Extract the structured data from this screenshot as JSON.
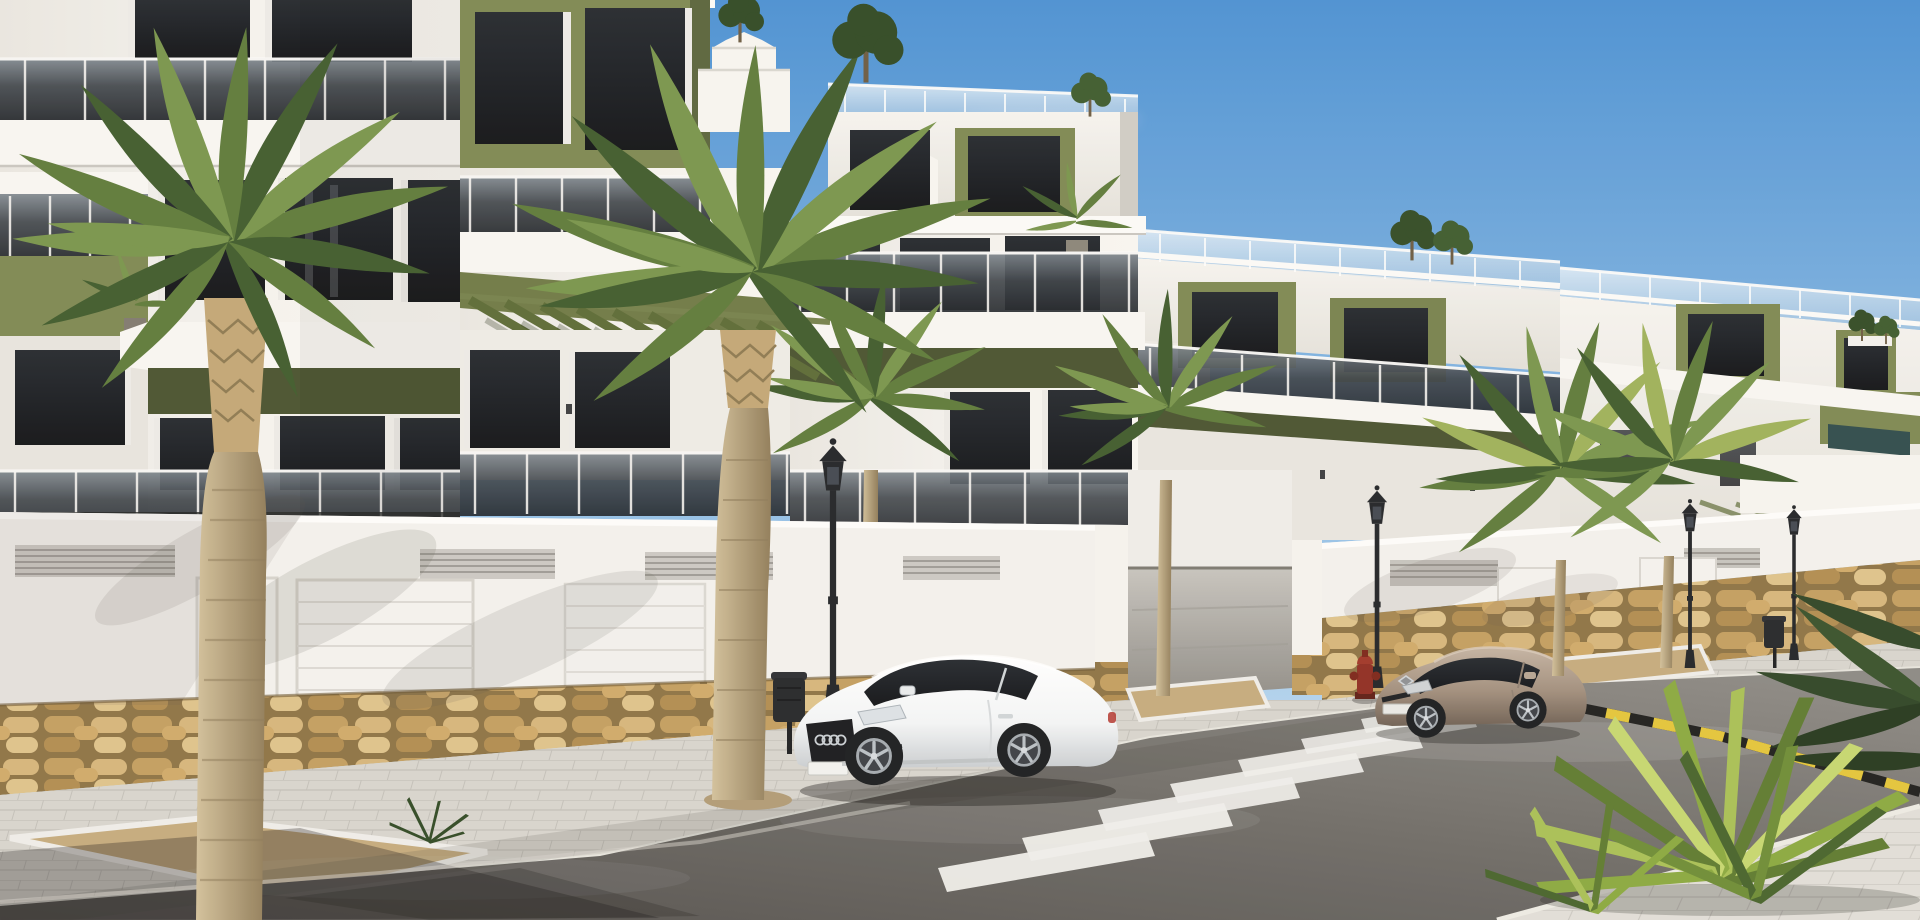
{
  "scene": {
    "domain": "natural-image",
    "description": "Sunny 3D architectural render of a modern white apartment complex with olive-green accent panels, smoked-glass balconies and roof terraces, viewed from across a street with parked cars, palm trees, street lamps and a zebra crossing",
    "time_of_day": "midday, sun from upper left",
    "weather": "clear blue sky with thin clouds near the horizon"
  },
  "palette": {
    "sky_top": "#4a90d2",
    "sky_mid": "#a8cdec",
    "sky_horizon": "#dcebf7",
    "cloud": "#f2f7fb",
    "facade_lit": "#f6f4ef",
    "facade_shaded": "#ddd9d2",
    "cornice": "#fbfaf7",
    "accent_olive": "#7d8751",
    "accent_olive_dark": "#59643a",
    "underside_olive": "#48522e",
    "window_glazing": "#181b20",
    "balcony_glass_top": "#7b848c",
    "balcony_glass_bottom": "#1c2025",
    "roof_glass": "#dfeaf2",
    "pergola_slat": "#5b6a34",
    "boundary_wall": "#f3f1ec",
    "stone_base": "#c8a669",
    "stone_grout": "#8d7243",
    "sidewalk": "#d7d4cd",
    "sidewalk_near": "#e1ded7",
    "asphalt_near": "#504d4a",
    "asphalt_far": "#8b8883",
    "crosswalk_white": "#efeeea",
    "curb_yellow": "#e3c438",
    "curb_black": "#1d1d1b",
    "car_white_body": "#f3f5f6",
    "car_bronze_body": "#a18e7c",
    "tyre_black": "#191b1d",
    "alloy_silver": "#9aa0a5",
    "lamp_metal": "#202225",
    "hydrant_red": "#8f2c20",
    "palm_frond_dark": "#3f5a2b",
    "palm_frond_mid": "#5d7a38",
    "palm_frond_light": "#78944a",
    "palm_trunk_light": "#d2c09a",
    "palm_trunk_dark": "#8f7b57",
    "yucca_light": "#c6d66e",
    "yucca_mid": "#8aa83e",
    "gravel": "#c4aa7c"
  },
  "objects": {
    "buildings": {
      "blocks_visible": 5,
      "storeys": 3,
      "features": [
        "roof terraces with frameless glass railings",
        "olive-green feature panels",
        "smoked-glass balcony balustrades",
        "green pergola slats over ground-floor terraces",
        "white boundary wall with louvre vents and garage doors",
        "natural stone plinth"
      ]
    },
    "vehicles": [
      {
        "id": "car-white-coupe",
        "body_color": "white",
        "type": "two-door coupe",
        "state": "parked facing left"
      },
      {
        "id": "car-bronze-coupe",
        "body_color": "bronze",
        "type": "two-door coupe",
        "state": "parked beyond the crossing"
      }
    ],
    "street_furniture": {
      "lamp_posts": 4,
      "litter_bins": 2,
      "fire_hydrants": 1,
      "garage_doors": 4,
      "pedestrian_doors": 1,
      "louvre_vents": 6
    },
    "road": {
      "crosswalk_stripes": 8,
      "kerb_marking": "yellow-black hatched",
      "surface": "asphalt"
    },
    "vegetation": {
      "palm_trees": 6,
      "roof_shrubs": 7,
      "balcony_plants": 3,
      "foreground_yucca": 1,
      "planters": 3
    }
  }
}
